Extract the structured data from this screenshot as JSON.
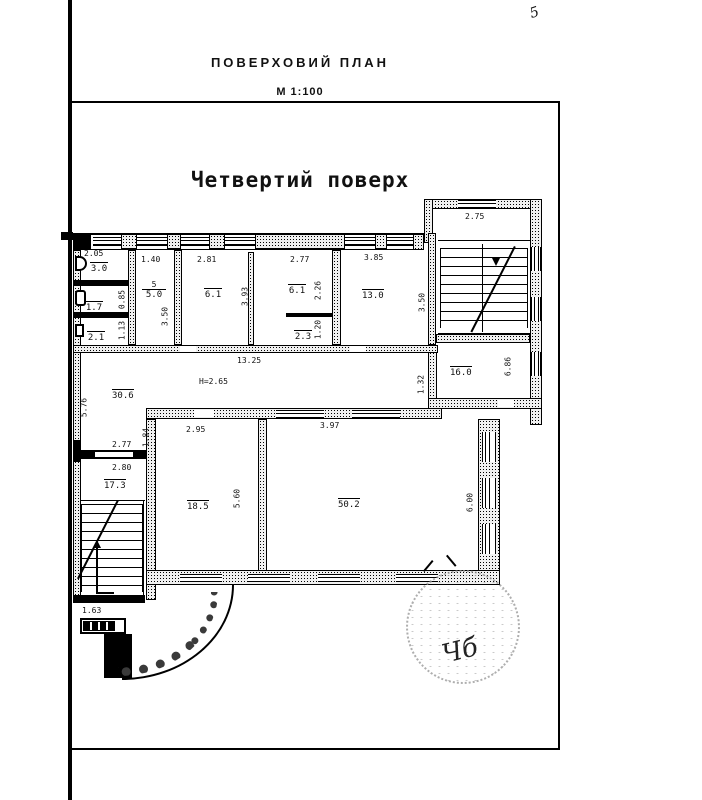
{
  "meta": {
    "drawing_title": "ПОВЕРХОВИЙ ПЛАН",
    "scale": "М 1:100",
    "floor_heading": "Четвертий поверх",
    "corner_mark": "5",
    "height_note": "Н=2.65",
    "stamp_signature": "Чб"
  },
  "rooms": {
    "wc_top": {
      "area": "3.0"
    },
    "wc_mid": {
      "area": "1.7"
    },
    "wc_bot": {
      "area": "2.1"
    },
    "room5": {
      "number": "5",
      "area": "5.0"
    },
    "room6a": {
      "area": "6.1"
    },
    "room6b": {
      "area": "6.1"
    },
    "room23": {
      "area": "2.3"
    },
    "room13": {
      "area": "13.0"
    },
    "room16": {
      "area": "16.0"
    },
    "corridor": {
      "area": "30.6"
    },
    "room173": {
      "area": "17.3"
    },
    "room185": {
      "area": "18.5"
    },
    "room502": {
      "area": "50.2"
    }
  },
  "dims": {
    "w205": "2.05",
    "w140": "1.40",
    "w281": "2.81",
    "w277_top": "2.77",
    "w385": "3.85",
    "w275": "2.75",
    "w1325": "13.25",
    "w295": "2.95",
    "w397": "3.97",
    "w277_left": "2.77",
    "w280": "2.80",
    "w163": "1.63",
    "h085": "0.85",
    "h113": "1.13",
    "h350_left": "3.50",
    "h393": "3.93",
    "h226": "2.26",
    "h120": "1.20",
    "h350_right": "3.50",
    "h686": "6.86",
    "h132": "1.32",
    "h576": "5.76",
    "h184": "1.84",
    "h560": "5.60",
    "h600": "6.00"
  }
}
